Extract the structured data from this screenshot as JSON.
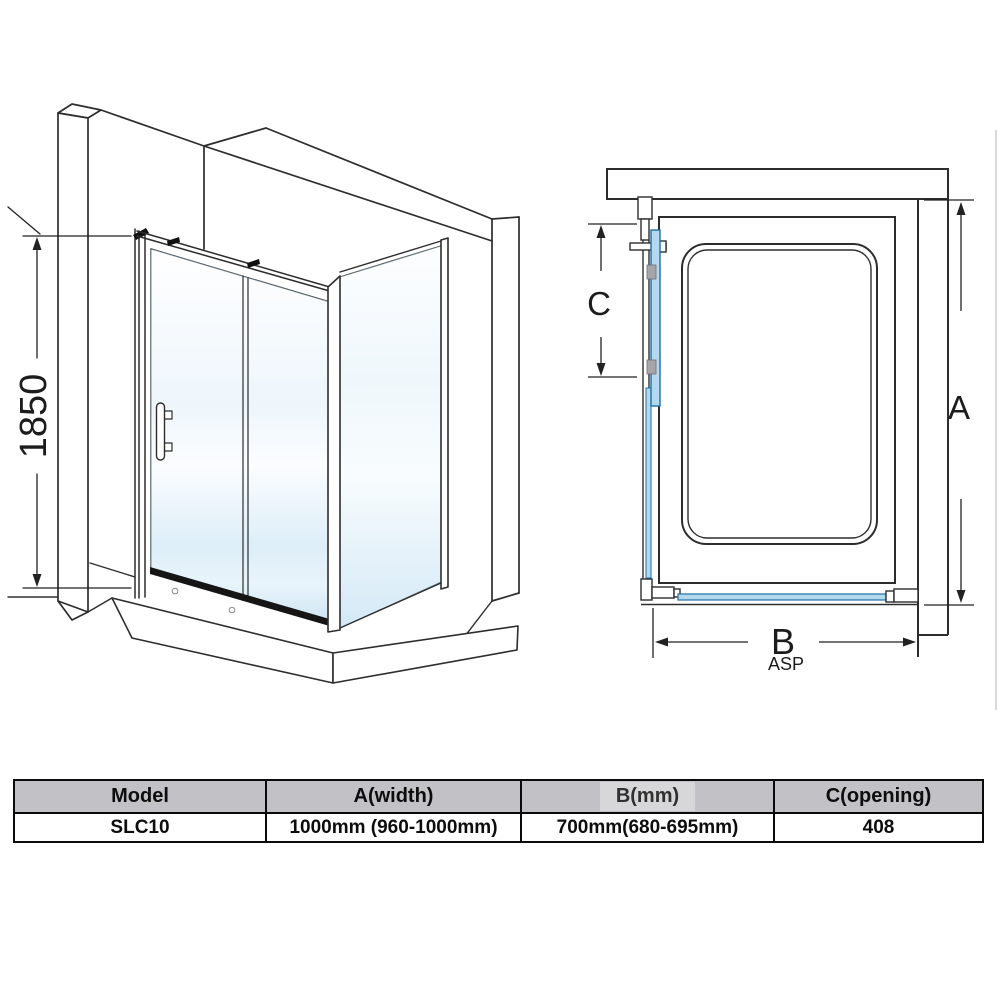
{
  "dimensions": {
    "height": "1850",
    "a": "A",
    "b": "B",
    "c": "C",
    "asp": "ASP"
  },
  "spec_table": {
    "headers": [
      "Model",
      "A(width)",
      "B(mm)",
      "C(opening)"
    ],
    "rows": [
      [
        "SLC10",
        "1000mm (960-1000mm)",
        "700mm(680-695mm)",
        "408"
      ]
    ]
  },
  "colors": {
    "line": "#2d2d2d",
    "glass_fill": "#b3d9ef",
    "glass_stroke": "#1e6fa8",
    "roller_fill": "#a6a6aa",
    "rail_black": "#151515",
    "header_bg": "#c2c2c6",
    "b_patch_bg": "#d7d7d9",
    "glass3d_top": "#ffffff",
    "glass3d_bottom": "#cfe6f4",
    "edge_line": "#d9d9d9"
  }
}
